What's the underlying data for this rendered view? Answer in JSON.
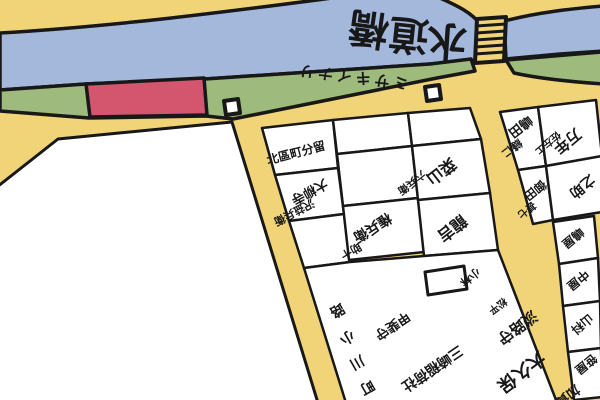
{
  "map_type": "hand-drawn Edo-era style district map",
  "colors": {
    "background_road": "#F2D478",
    "river": "#A3B8DB",
    "riverbank_green": "#9FBA7D",
    "shrine_site_red": "#D4556E",
    "plot_white": "#FFFFFF",
    "outline": "#181818"
  },
  "river": {
    "bridge_name": "水道橋",
    "label_chars": [
      "水",
      "道",
      "橋"
    ]
  },
  "bank": {
    "shrine_path_label": "ミサキイナリ"
  },
  "street": {
    "label_chars": [
      "路",
      "小",
      "川",
      "町"
    ]
  },
  "plots": [
    {
      "name": "北區町分留",
      "sub": ""
    },
    {
      "name": "大柳寺",
      "sub": "沢益兵衛"
    },
    {
      "name": "権兵衛",
      "sub": "助十"
    },
    {
      "name": "菜山",
      "sub": "六兵衛"
    },
    {
      "name": "龍吉",
      "sub": "小林"
    },
    {
      "name": "嶋田",
      "sub": "縫仁"
    },
    {
      "name": "御田",
      "sub": "甚七"
    },
    {
      "name": "万年",
      "sub": "佐左エ"
    },
    {
      "name": "之助",
      "sub": ""
    },
    {
      "name": "甲斐守",
      "sub": ""
    },
    {
      "name": "三崎稲荷社",
      "sub": ""
    },
    {
      "name": "淡路守",
      "sub": "松平"
    },
    {
      "name": "大久保",
      "sub": "加賀守"
    },
    {
      "name": "嶋屋",
      "sub": ""
    },
    {
      "name": "中屋",
      "sub": ""
    },
    {
      "name": "山科",
      "sub": ""
    },
    {
      "name": "笹屋",
      "sub": ""
    }
  ]
}
